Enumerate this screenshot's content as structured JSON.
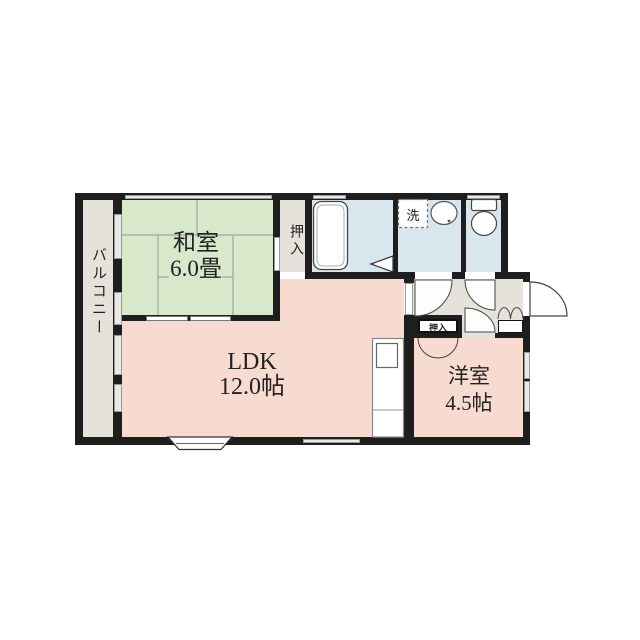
{
  "title": "apartment-floorplan",
  "rooms": {
    "washitsu": {
      "name": "和室",
      "size": "6.0畳"
    },
    "ldk": {
      "name": "LDK",
      "size": "12.0帖"
    },
    "youshitsu": {
      "name": "洋室",
      "size": "4.5帖"
    },
    "balcony": {
      "name": "バルコニー"
    },
    "closet_main": {
      "name": "押入"
    },
    "closet_youshitsu": {
      "name": "押入"
    },
    "laundry": {
      "name": "洗"
    }
  },
  "colors": {
    "wall": "#1e1e1e",
    "washitsu": "#d7e8cb",
    "ldk": "#f8dbd0",
    "wet": "#dae6ee",
    "service": "#e4e2da",
    "window": "#e9e9e5",
    "line": "#999999"
  }
}
